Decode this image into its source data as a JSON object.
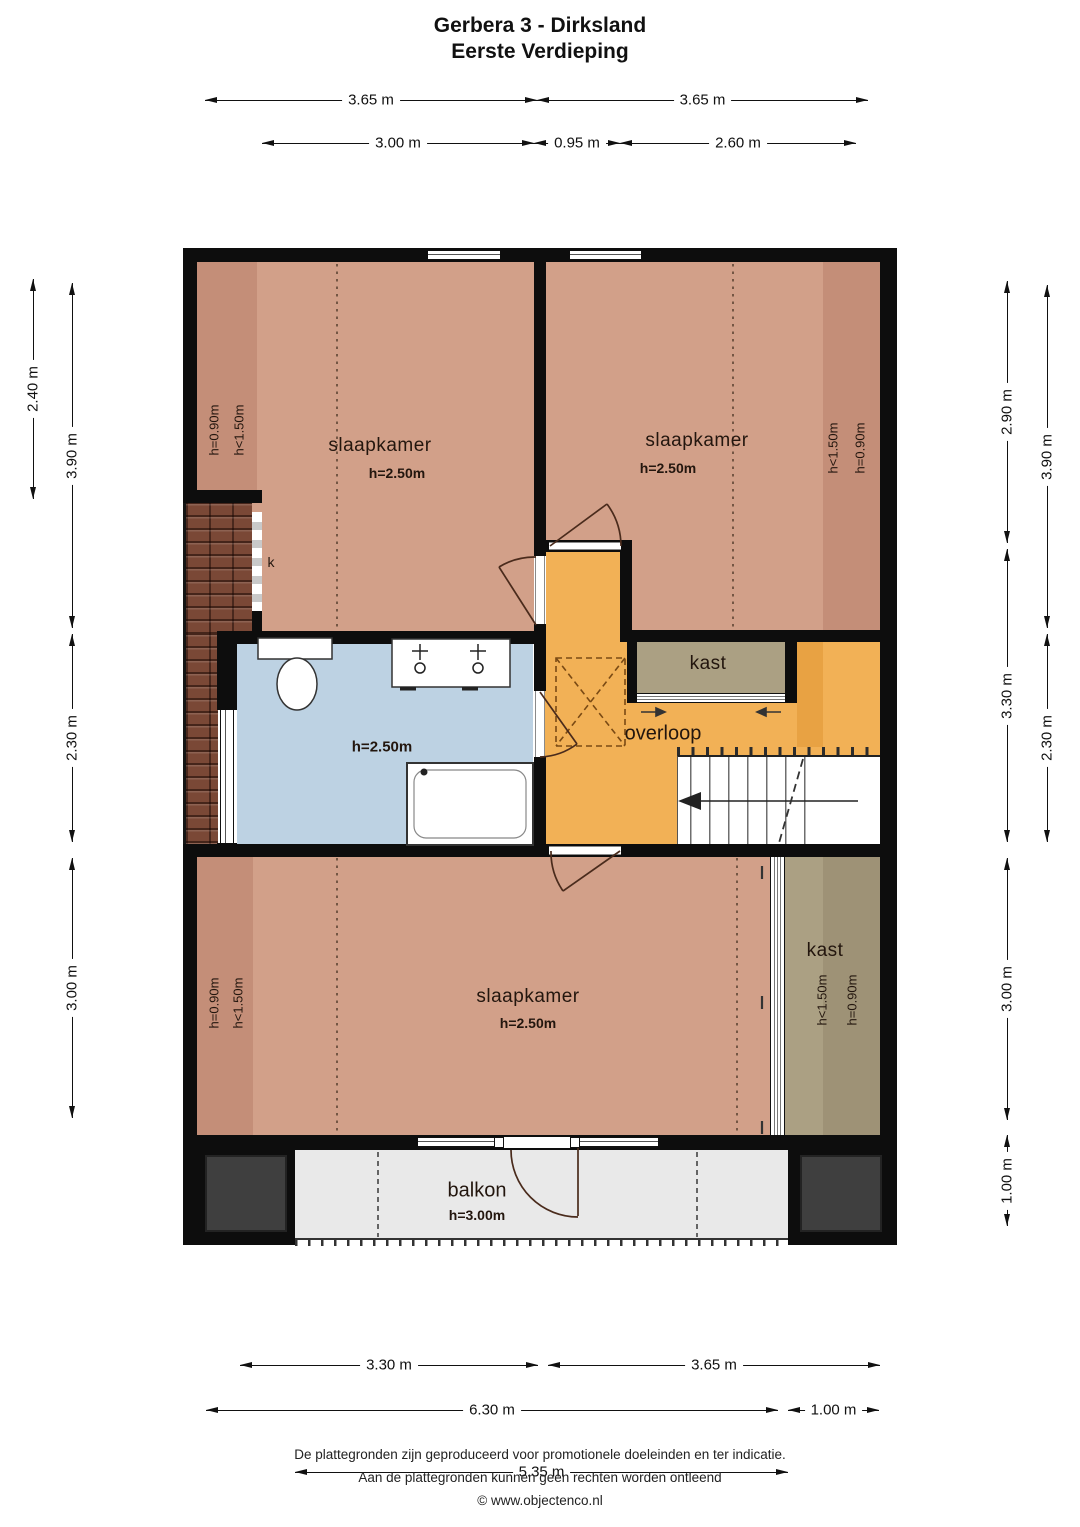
{
  "title": {
    "line1": "Gerbera 3 - Dirksland",
    "line2": "Eerste Verdieping"
  },
  "rooms": {
    "bedroom_nw": {
      "label": "slaapkamer",
      "ceiling": "h=2.50m",
      "slope_a": "h=0.90m",
      "slope_b": "h<1.50m"
    },
    "bedroom_ne": {
      "label": "slaapkamer",
      "ceiling": "h=2.50m",
      "slope_a": "h<1.50m",
      "slope_b": "h=0.90m"
    },
    "bedroom_s": {
      "label": "slaapkamer",
      "ceiling": "h=2.50m",
      "slope_a": "h=0.90m",
      "slope_b": "h<1.50m"
    },
    "bathroom": {
      "ceiling": "h=2.50m"
    },
    "landing": {
      "label": "overloop"
    },
    "closet_mid": {
      "label": "kast"
    },
    "closet_se": {
      "label": "kast",
      "slope_a": "h<1.50m",
      "slope_b": "h=0.90m"
    },
    "balcony": {
      "label": "balkon",
      "ceiling": "h=3.00m"
    },
    "knee_wall": {
      "label": "k"
    }
  },
  "dimensions": {
    "top_row1": [
      "3.65 m",
      "3.65 m"
    ],
    "top_row2": [
      "3.00 m",
      "0.95 m",
      "2.60 m"
    ],
    "left_outer": [
      "2.40 m"
    ],
    "left_inner": [
      "3.90 m",
      "2.30 m",
      "3.00 m"
    ],
    "right_inner": [
      "2.90 m",
      "3.30 m",
      "3.00 m",
      "1.00 m"
    ],
    "right_outer": [
      "3.90 m",
      "2.30 m"
    ],
    "bottom_row1": [
      "3.30 m",
      "3.65 m"
    ],
    "bottom_row2": [
      "6.30 m",
      "1.00 m"
    ],
    "bottom_row3": [
      "5.35 m"
    ]
  },
  "footer": {
    "line1": "De plattegronden zijn geproduceerd voor promotionele doeleinden en ter indicatie.",
    "line2": "Aan de plattegronden kunnen geen rechten worden ontleend",
    "line3": "© www.objectenco.nl"
  },
  "colors": {
    "wall": "#0d0d0d",
    "room": "#d2a089",
    "room_dark": "#c48e78",
    "bath": "#bdd2e3",
    "landing": "#f2b156",
    "landing_dark": "#e8a243",
    "closet": "#aba083",
    "closet_dark": "#9e9276",
    "balcony": "#e9e9e9",
    "roof": "#7a4836",
    "block": "#3f3f3f",
    "door_line": "#4a2b1c"
  }
}
